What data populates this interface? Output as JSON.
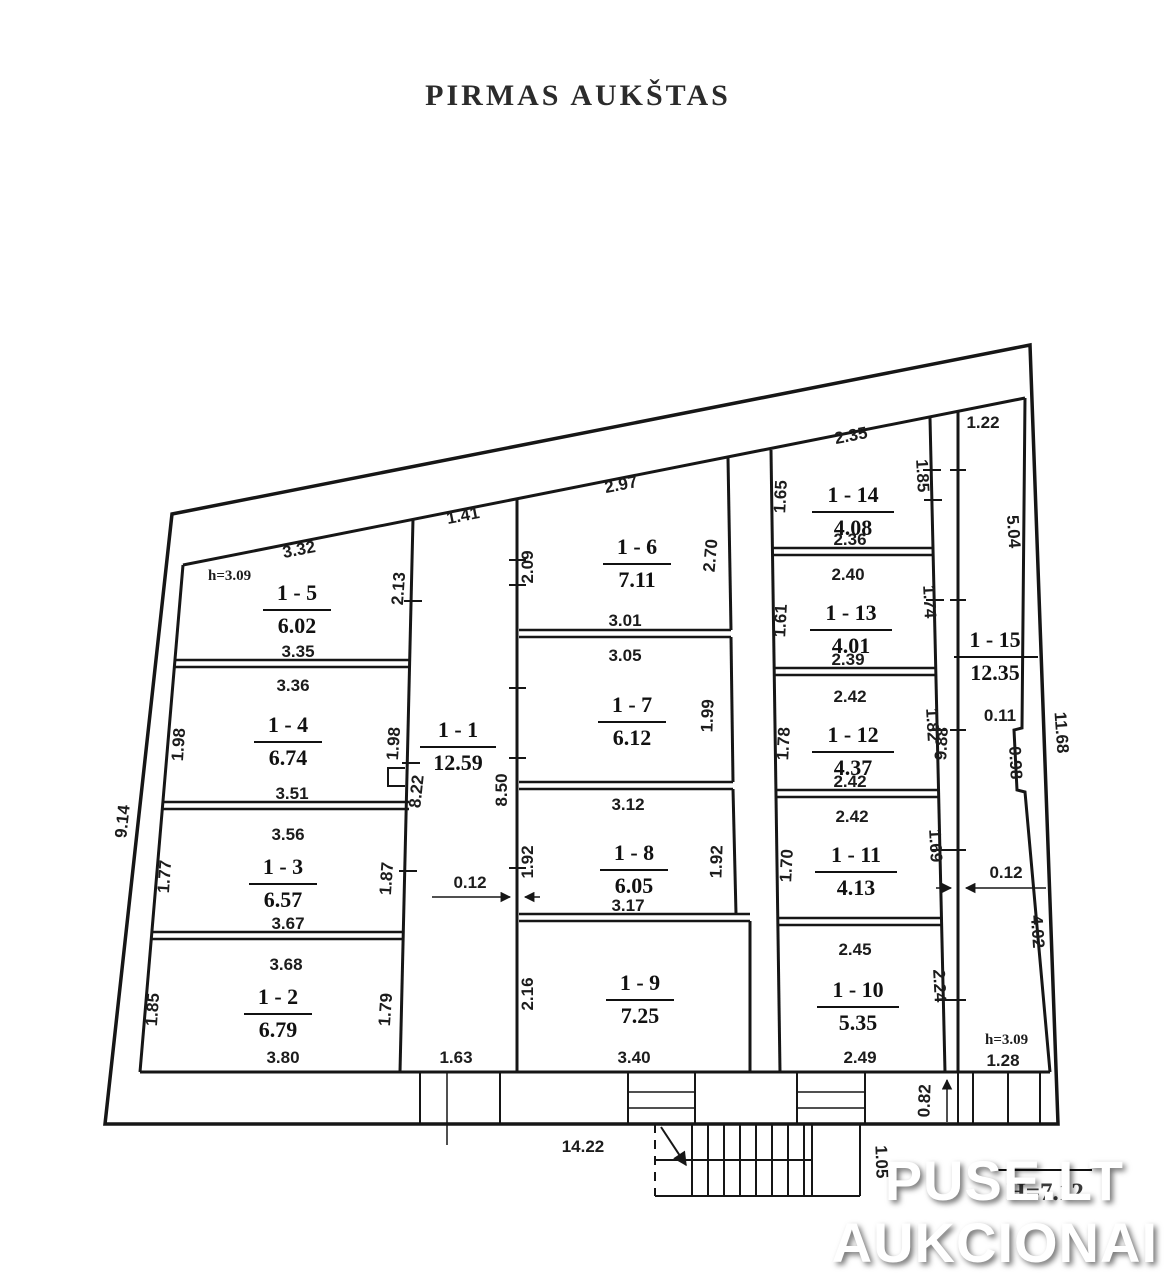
{
  "title": "PIRMAS AUKŠTAS",
  "watermark": {
    "line1": "PUSE.LT",
    "line2": "AUKCIONAI"
  },
  "obscured_note": "H=7.12",
  "rooms": {
    "r1": {
      "label": "1 - 1",
      "area": "12.59",
      "top": "1.41",
      "bottom": "1.63",
      "left_wall": "8.22",
      "right_wall": "8.50"
    },
    "r2": {
      "label": "1 - 2",
      "area": "6.79",
      "top": "3.68",
      "bottom": "3.80",
      "left": "1.85",
      "right": "1.79"
    },
    "r3": {
      "label": "1 - 3",
      "area": "6.57",
      "top": "3.56",
      "bottom": "3.67",
      "left": "1.77",
      "right": "1.87"
    },
    "r4": {
      "label": "1 - 4",
      "area": "6.74",
      "top": "3.36",
      "bottom": "3.51",
      "left": "1.98",
      "right": "1.98"
    },
    "r5": {
      "label": "1 - 5",
      "area": "6.02",
      "top": "3.32",
      "bottom": "3.35",
      "right": "2.13",
      "height_note": "h=3.09"
    },
    "r6": {
      "label": "1 - 6",
      "area": "7.11",
      "top": "2.97",
      "bottom": "3.01",
      "left": "2.09",
      "right": "2.70"
    },
    "r7": {
      "label": "1 - 7",
      "area": "6.12",
      "top": "3.05",
      "right": "1.99"
    },
    "r8": {
      "label": "1 - 8",
      "area": "6.05",
      "top": "3.12",
      "bottom": "3.17",
      "left": "1.92",
      "right": "1.92"
    },
    "r9": {
      "label": "1 - 9",
      "area": "7.25",
      "bottom": "3.40",
      "left": "2.16"
    },
    "r10": {
      "label": "1 - 10",
      "area": "5.35",
      "top": "2.45",
      "bottom": "2.49",
      "right": "2.24"
    },
    "r11": {
      "label": "1 - 11",
      "area": "4.13",
      "top": "2.42",
      "left": "1.70",
      "right": "1.69"
    },
    "r12": {
      "label": "1 - 12",
      "area": "4.37",
      "top": "2.42",
      "bottom": "2.42",
      "left": "1.78",
      "right": "1.82"
    },
    "r13": {
      "label": "1 - 13",
      "area": "4.01",
      "top": "2.40",
      "bottom": "2.39",
      "left": "1.61",
      "right": "1.74"
    },
    "r14": {
      "label": "1 - 14",
      "area": "4.08",
      "top": "2.35",
      "bottom": "2.36",
      "left": "1.65",
      "right": "1.85"
    },
    "r15": {
      "label": "1 - 15",
      "area": "12.35",
      "top": "1.22",
      "bottom": "1.28",
      "height_note": "h=3.09"
    }
  },
  "dimensions": {
    "outer_left": "9.14",
    "outer_bottom": "14.22",
    "outer_right_total": "11.68",
    "right_wall_upper": "5.04",
    "right_wall_offset": "0.11",
    "right_wall_jog": "0.98",
    "right_wall_lower": "4.02",
    "corridor_right": "9.88",
    "wall_thickness_left": "0.12",
    "wall_thickness_right": "0.12",
    "stair_width": "1.05",
    "porch_depth": "0.82"
  }
}
